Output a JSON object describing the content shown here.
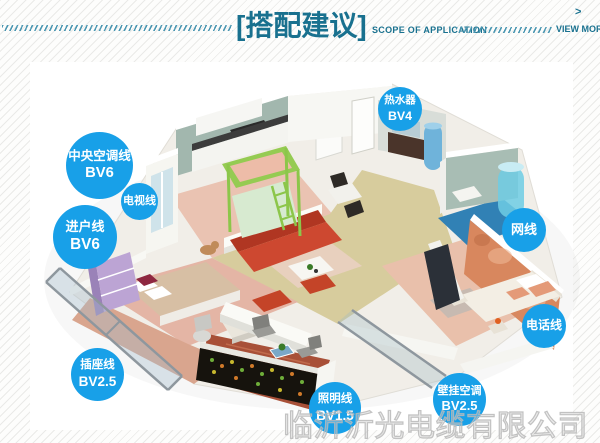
{
  "header": {
    "title": "[搭配建议]",
    "subtitle": "SCOPE OF APPLICATION",
    "view_more": "VIEW MOR",
    "view_more_arrow": ">",
    "accent_color": "#19718f"
  },
  "callout_style": {
    "fill_color": "#18a0e8",
    "text_color": "#ffffff"
  },
  "callouts": [
    {
      "id": "central-ac-line",
      "line1": "中央空调线",
      "line2": "BV6"
    },
    {
      "id": "tv-line",
      "line1": "电视线",
      "line2": ""
    },
    {
      "id": "entry-line",
      "line1": "进户线",
      "line2": "BV6"
    },
    {
      "id": "water-heater",
      "line1": "热水器",
      "line2": "BV4"
    },
    {
      "id": "network-cable",
      "line1": "网线",
      "line2": ""
    },
    {
      "id": "phone-line",
      "line1": "电话线",
      "line2": ""
    },
    {
      "id": "socket-line",
      "line1": "插座线",
      "line2": "BV2.5"
    },
    {
      "id": "lighting-line",
      "line1": "照明线",
      "line2": "BV1.5"
    },
    {
      "id": "wall-ac",
      "line1": "壁挂空调",
      "line2": "BV2.5"
    }
  ],
  "watermark": "临沂沂光电缆有限公司"
}
